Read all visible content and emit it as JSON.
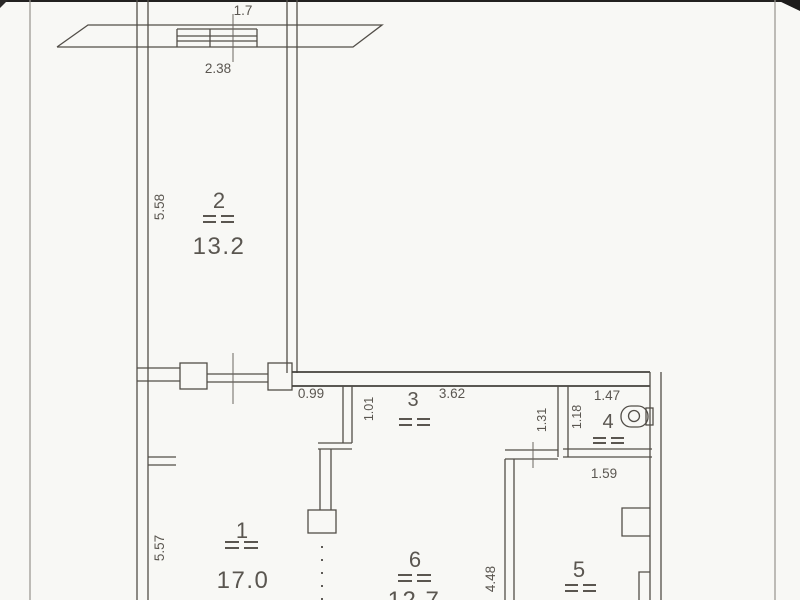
{
  "document": {
    "type": "scanned apartment floor plan",
    "units": "meters / square meters"
  },
  "colors": {
    "wall_line": "#524e48",
    "text": "#5a5650",
    "paper": "#f8f8f5",
    "scan_edge": "#96938d"
  },
  "rooms": [
    {
      "number": "1",
      "area": "17.0",
      "side_dim": "5.57"
    },
    {
      "number": "2",
      "area": "13.2",
      "side_dim": "5.58"
    },
    {
      "number": "3",
      "top_dim": "3.62",
      "side_dim": "1.01"
    },
    {
      "number": "4",
      "top_dim": "1.47",
      "side_dim": "1.18"
    },
    {
      "number": "5",
      "top_dim": "1.59"
    },
    {
      "number": "6",
      "area": "12.7",
      "side_dim": "4.48"
    }
  ],
  "dimensions": {
    "balcony_length": "1.7",
    "window_width": "2.38",
    "doorway_width": "0.99",
    "corridor_right_wall": "1.31"
  }
}
